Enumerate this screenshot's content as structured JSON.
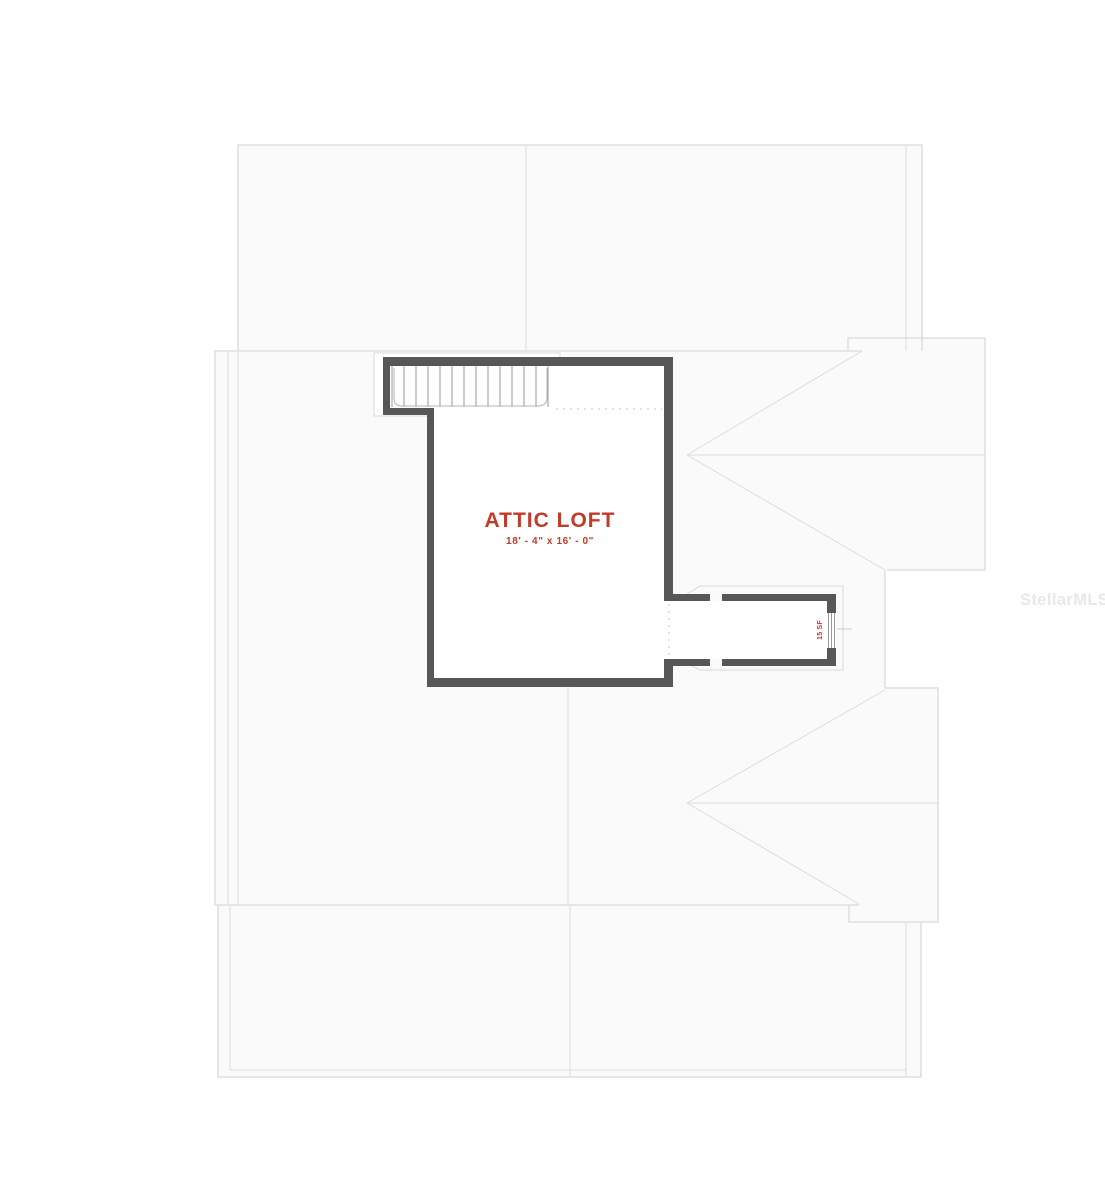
{
  "floor_plan": {
    "room": {
      "name": "ATTIC LOFT",
      "dimensions": "18' - 4\" x 16' - 0\""
    },
    "dormer_label": "15 SF",
    "watermark": "StellarMLS",
    "colors": {
      "room_label": "#c13a2a",
      "walls": "#575757",
      "roof_outline": "#dadada",
      "roof_fill": "#fafafa",
      "watermark": "#e8e8e8"
    }
  }
}
